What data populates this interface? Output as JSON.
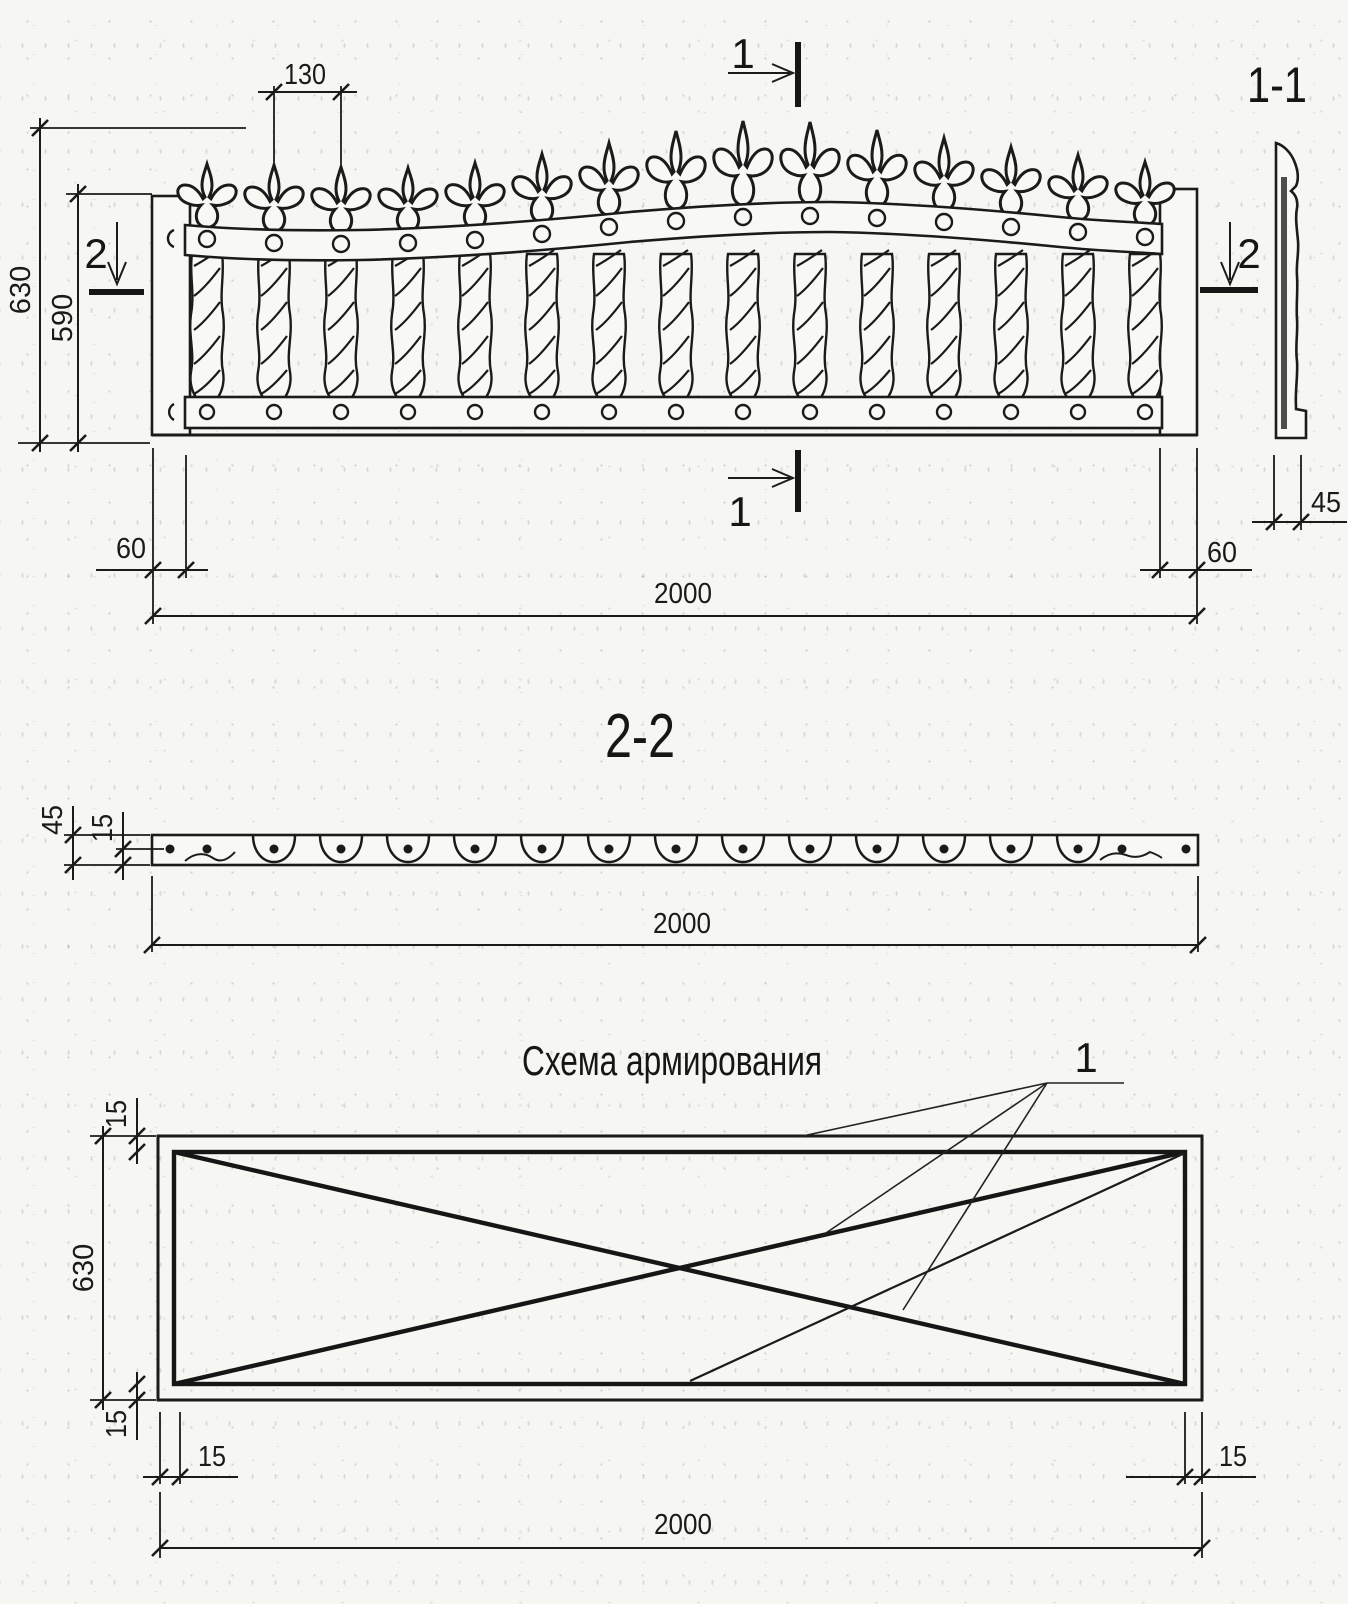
{
  "colors": {
    "ink": "#1b1b1b",
    "paper": "#f6f6f3"
  },
  "elevation": {
    "dim_finial_spacing": "130",
    "dim_height_total": "630",
    "dim_height_inner": "590",
    "dim_edge_left": "60",
    "dim_edge_right": "60",
    "dim_width": "2000",
    "dim_section_thickness": "45",
    "marker_top": "1",
    "marker_bottom": "1",
    "marker_left": "2",
    "marker_right": "2",
    "side_section_title": "1-1"
  },
  "section22": {
    "title": "2-2",
    "dim_thickness": "45",
    "dim_cover": "15",
    "dim_width": "2000"
  },
  "reinforcement": {
    "title": "Схема армирования",
    "bar_callout": "1",
    "dim_offset_top": "15",
    "dim_height": "630",
    "dim_offset_bottom": "15",
    "dim_offset_left": "15",
    "dim_offset_right": "15",
    "dim_width": "2000"
  }
}
